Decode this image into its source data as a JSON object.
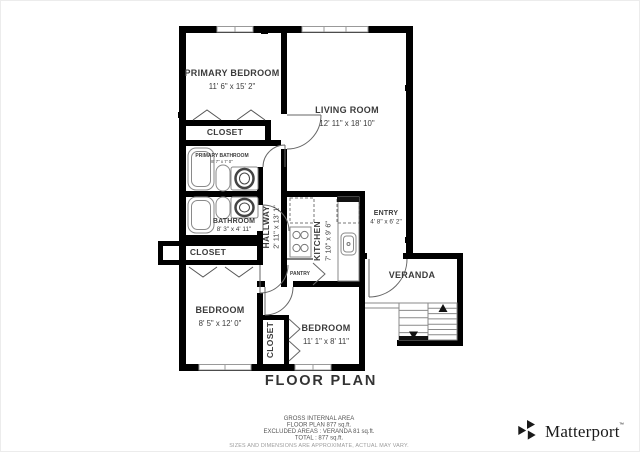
{
  "rooms": {
    "primary_bedroom": {
      "name": "PRIMARY BEDROOM",
      "dims": "11' 6\" x 15' 2\""
    },
    "living_room": {
      "name": "LIVING ROOM",
      "dims": "12' 11\" x 18' 10\""
    },
    "closet_primary": {
      "name": "CLOSET"
    },
    "primary_bathroom": {
      "name": "PRIMARY BATHROOM",
      "dims": "8' 7\" x 7' 0\""
    },
    "bathroom": {
      "name": "BATHROOM",
      "dims": "8' 3\" x 4' 11\""
    },
    "hallway": {
      "name": "HALLWAY",
      "dims": "2' 11\" x 13' 1\""
    },
    "kitchen": {
      "name": "KITCHEN",
      "dims": "7' 10\" x 9' 6\""
    },
    "pantry": {
      "name": "PANTRY"
    },
    "entry": {
      "name": "ENTRY",
      "dims": "4' 8\" x 6' 2\""
    },
    "veranda": {
      "name": "VERANDA"
    },
    "closet_hall": {
      "name": "CLOSET"
    },
    "bedroom_left": {
      "name": "BEDROOM",
      "dims": "8' 5\" x 12' 0\""
    },
    "bedroom_right": {
      "name": "BEDROOM",
      "dims": "11' 1\" x 8' 11\""
    },
    "closet_bedroom": {
      "name": "CLOSET"
    }
  },
  "title": "FLOOR PLAN",
  "footer": {
    "line1": "GROSS INTERNAL AREA",
    "line2": "FLOOR PLAN 877 sq.ft.",
    "line3": "EXCLUDED AREAS :  VERANDA 81 sq.ft.",
    "line4": "TOTAL :  877 sq.ft.",
    "disclaimer": "SIZES AND DIMENSIONS ARE APPROXIMATE, ACTUAL MAY VARY."
  },
  "branding": {
    "logo_text": "Matterport",
    "trademark": "™"
  },
  "colors": {
    "wall": "#000000",
    "label": "#3b3b3b",
    "fixture": "#8a8a8a",
    "footer": "#555555",
    "disclaimer": "#9b9b9b",
    "logo": "#1a1a1a"
  }
}
